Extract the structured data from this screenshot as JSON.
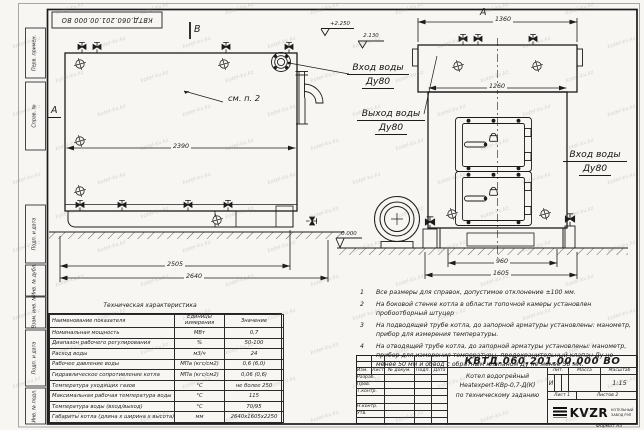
{
  "stamp_top": "КВТД.060.201.00.000 ВО",
  "watermark": {
    "text": "kotel-kv.kz"
  },
  "frame": {
    "left_labels": [
      "Перв. примен.",
      "Справ. №",
      "Подп. и дата",
      "Инв. № дубл.",
      "Взам. инв. №",
      "Подп. и дата",
      "Инв. № подл."
    ],
    "format_note": "Формат А3"
  },
  "views": {
    "side": {
      "section_b": "B",
      "section_a": "А",
      "see_note": "см. п. 2",
      "dim_inner": "2390",
      "dim_base": "2505",
      "dim_total": "2640",
      "elev_top": "+2.250",
      "elev_mid": "2.130",
      "elev_ground": "0.000"
    },
    "front": {
      "marker": "А",
      "dim_top": "1360",
      "dim_body": "1260",
      "dim_base": "960",
      "dim_total": "1605"
    },
    "labels": {
      "inlet_l1": "Вход воды",
      "inlet_l2": "Ду80",
      "outlet_l1": "Выход воды",
      "outlet_l2": "Ду80",
      "inlet_right_l1": "Вход воды",
      "inlet_right_l2": "Ду80"
    }
  },
  "tech": {
    "title": "Техническая характеристика",
    "h_name": "Наименование показателя",
    "h_units": "Единицы измерения",
    "h_value": "Значение",
    "rows": [
      [
        "Номинальная мощность",
        "МВт",
        "0,7"
      ],
      [
        "Диапазон рабочего регулирования",
        "%",
        "50-100"
      ],
      [
        "Расход воды",
        "м3/ч",
        "24"
      ],
      [
        "Рабочее давление воды",
        "МПа (кгс/см2)",
        "0,6 (6,0)"
      ],
      [
        "Гидравлическое сопротивление котла",
        "МПа (кгс/см2)",
        "0,06 (0,6)"
      ],
      [
        "Температура уходящих газов",
        "°С",
        "не более 250"
      ],
      [
        "Максимальная рабочая температура воды",
        "°С",
        "115"
      ],
      [
        "Температура воды (вход/выход)",
        "°С",
        "70/95"
      ],
      [
        "Габариты котла (длина х ширина х высота)",
        "мм",
        "2640х1605х2250"
      ]
    ]
  },
  "notes": [
    {
      "num": "1",
      "text": "Все размеры для справок, допустимое отклонение ±100 мм."
    },
    {
      "num": "2",
      "text": "На боковой стенке котла в области топочной камеры установлен пробоотборный штуцер"
    },
    {
      "num": "3",
      "text": "На подводящей трубе котла, до запорной арматуры установлены: манометр, прибор для измерения температуры."
    },
    {
      "num": "4",
      "text": "На отводящей трубе котла, до запорной арматуры установлены: манометр, прибор для измерения температуры, предохранительный клапан Ду не менее 50 мм и обвод с обратным клапаном Ду не менее 50 мм."
    }
  ],
  "title_block": {
    "doc_number": "КВТД.060.201.00.000  ВО",
    "col_izm": "Изм.",
    "col_list": "Лист",
    "col_doc": "№ докум.",
    "col_podp": "Подп.",
    "col_data": "Дата",
    "row_razrab": "Разраб.",
    "row_prov": "Пров.",
    "row_tkontr": "Т.контр.",
    "row_nkontr": "Н.контр.",
    "row_utv": "Утв.",
    "name_l1": "Котел водогрейный",
    "name_l2": "Heatexpert-КВр-0,7-Д(К)",
    "name_l3": "по техническому заданию",
    "lit_label": "Лит.",
    "lit_value": "И",
    "mass_label": "Масса",
    "scale_label": "Масштаб",
    "scale_value": "1:15",
    "sheet_text": "Лист  1",
    "sheets_text": "Листов  2",
    "logo_text": "KVZR",
    "logo_cap1": "КОТЕЛЬНЫЙ",
    "logo_cap2": "ЗАВОД РЭП"
  }
}
